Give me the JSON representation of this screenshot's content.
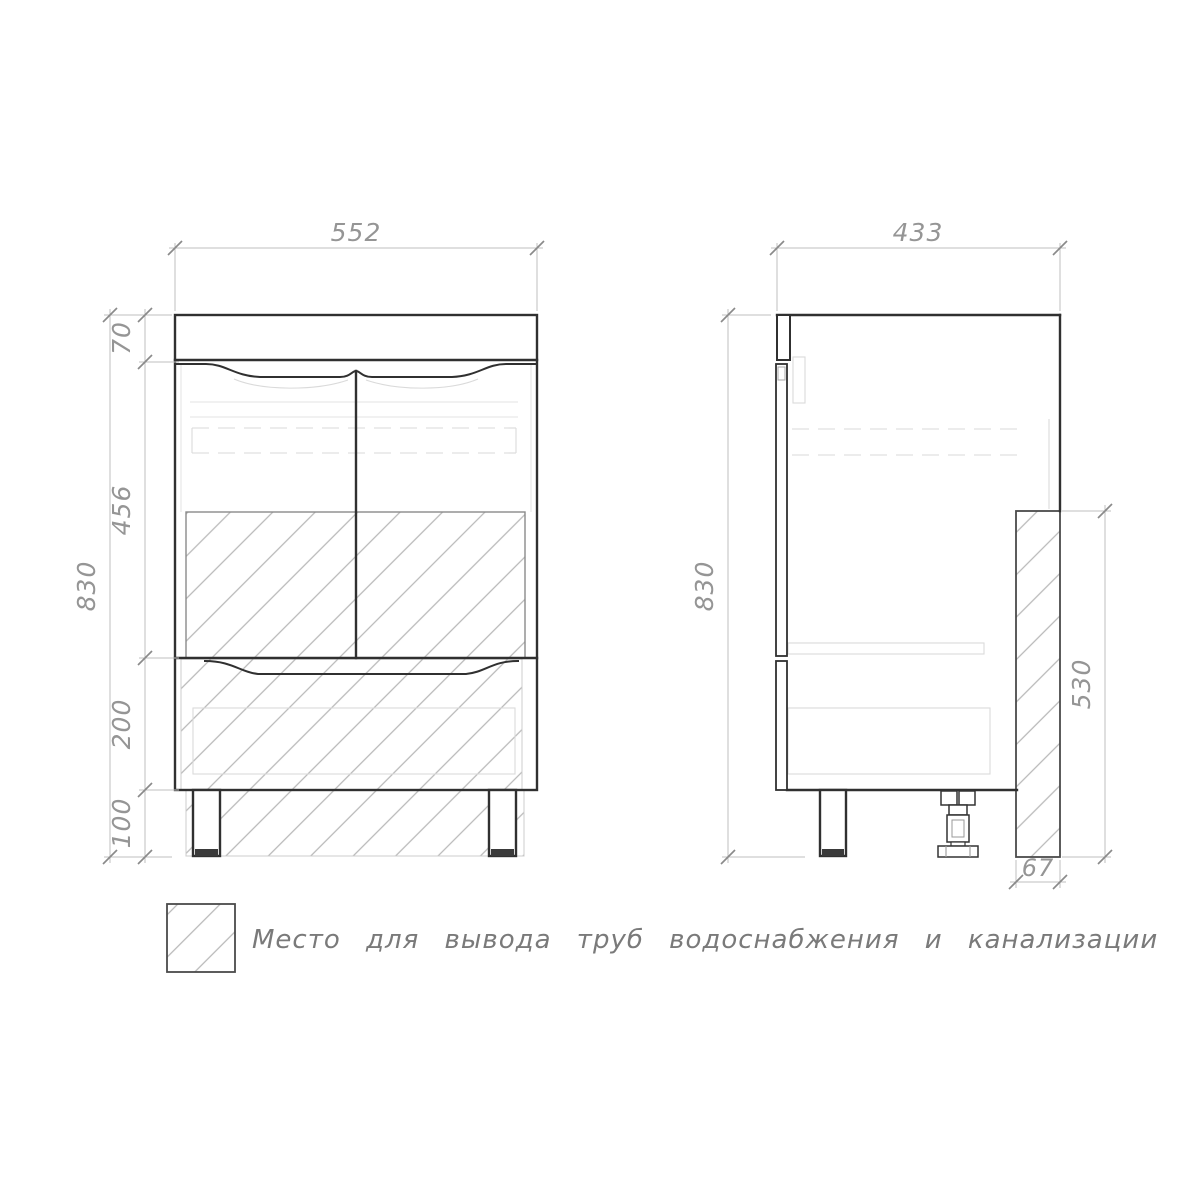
{
  "front_view": {
    "dim_width": "552",
    "dim_top_section": "70",
    "dim_door_section": "456",
    "dim_drawer_section": "200",
    "dim_leg_height": "100",
    "dim_total_height": "830"
  },
  "side_view": {
    "dim_depth": "433",
    "dim_total_height": "830",
    "dim_pipe_zone_height": "530",
    "dim_pipe_zone_depth": "67"
  },
  "legend": {
    "text": "Место для вывода труб водоснабжения и канализации"
  },
  "colors": {
    "line_bold": "#303030",
    "line_faint": "#d9d9d9",
    "hatch": "#b8b8b8",
    "dimension": "#959595",
    "background": "#ffffff"
  }
}
